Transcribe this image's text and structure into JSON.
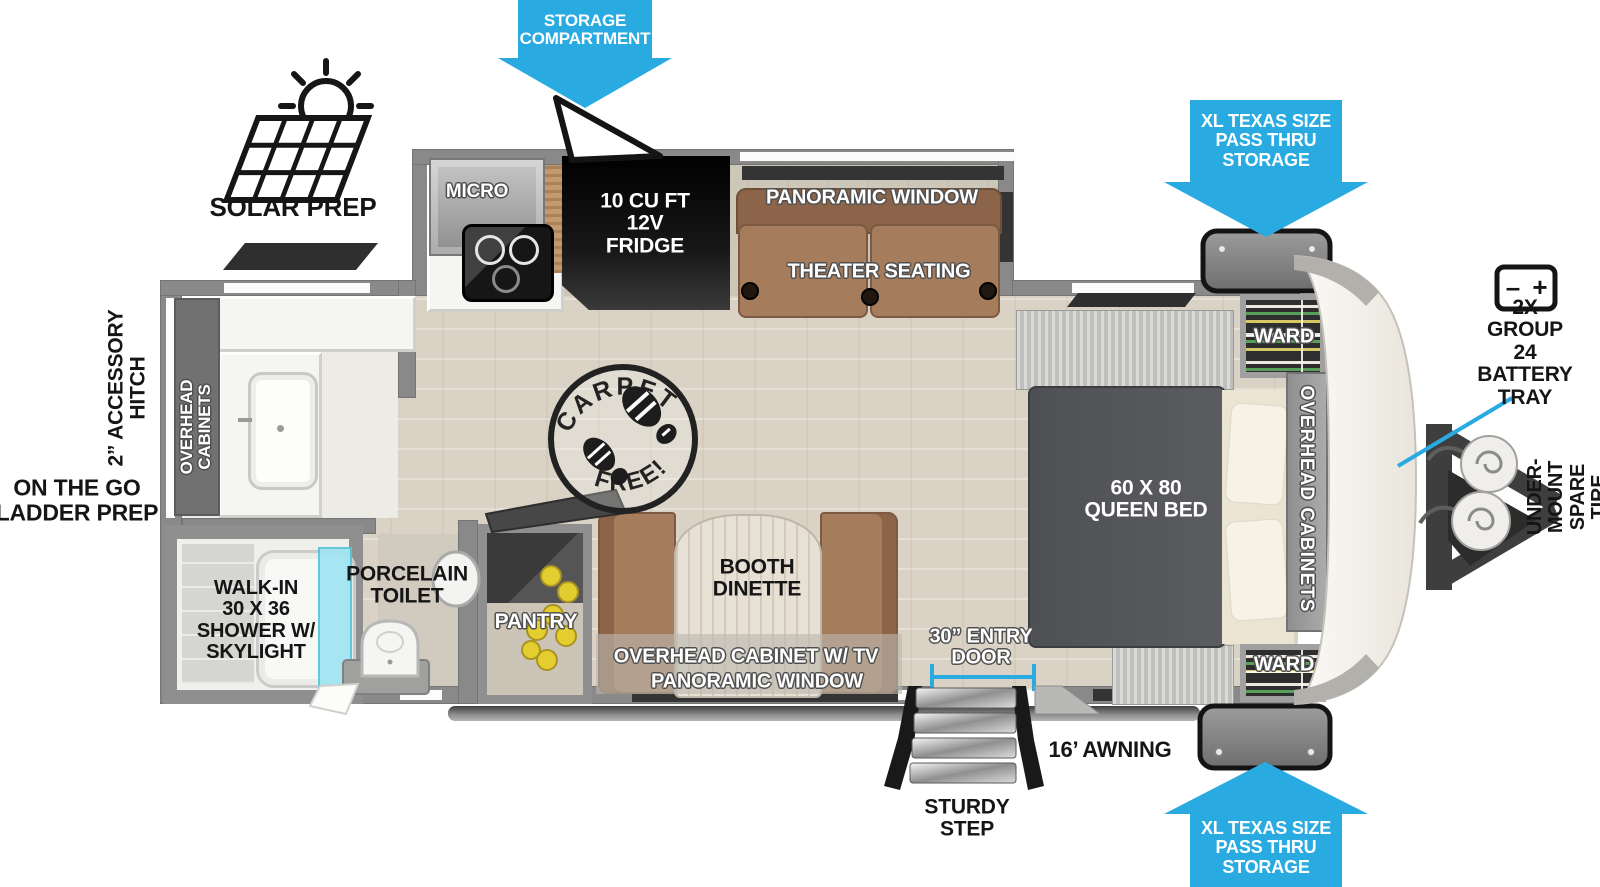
{
  "colors": {
    "arrow_blue": "#29abe2",
    "wall_gray": "#898989",
    "sofa_brown": "#a57c5c",
    "bed_gray": "#54565a",
    "floor_tan": "#d9d2c5",
    "shower_glass": "#9fe5f2",
    "cans_yellow": "#e4cd2f",
    "front_cap_cream": "#f6f4ef",
    "fridge_black": "#121212"
  },
  "callouts": {
    "storage_compartment": "STORAGE\nCOMPARTMENT",
    "pass_thru_top": "XL TEXAS SIZE\nPASS THRU\nSTORAGE",
    "pass_thru_bottom": "XL TEXAS SIZE\nPASS THRU\nSTORAGE",
    "battery_tray": "2X GROUP 24\nBATTERY\nTRAY",
    "spare_tire": "UNDER-MOUNT\nSPARE TIRE",
    "solar_prep": "SOLAR PREP",
    "accessory_hitch": "2” ACCESSORY\nHITCH",
    "ladder_prep": "ON THE GO\nLADDER PREP",
    "awning": "16’ AWNING",
    "sturdy_step": "STURDY\nSTEP",
    "entry_door": "30” ENTRY\nDOOR"
  },
  "kitchen": {
    "micro": "MICRO",
    "fridge": "10 CU FT\n12V\nFRIDGE",
    "panoramic_window": "PANORAMIC WINDOW",
    "theater_seating": "THEATER SEATING",
    "pantry": "PANTRY"
  },
  "dinette": {
    "booth": "BOOTH\nDINETTE",
    "overhead_cabinet": "OVERHEAD CABINET W/ TV",
    "panoramic_window": "PANORAMIC WINDOW"
  },
  "bedroom": {
    "queen_bed": "60 X 80\nQUEEN BED",
    "ward_top": "WARD",
    "ward_bottom": "WARD",
    "overhead_cabinets": "OVERHEAD CABINETS"
  },
  "bathroom": {
    "overhead_cabinets": "OVERHEAD\nCABINETS",
    "shower": "WALK-IN\n30 X 36\nSHOWER W/\nSKYLIGHT",
    "toilet": "PORCELAIN\nTOILET"
  },
  "stamp": {
    "top": "CARPET",
    "bottom": "FREE!"
  },
  "battery_icon": {
    "minus": "–",
    "plus": "+"
  }
}
